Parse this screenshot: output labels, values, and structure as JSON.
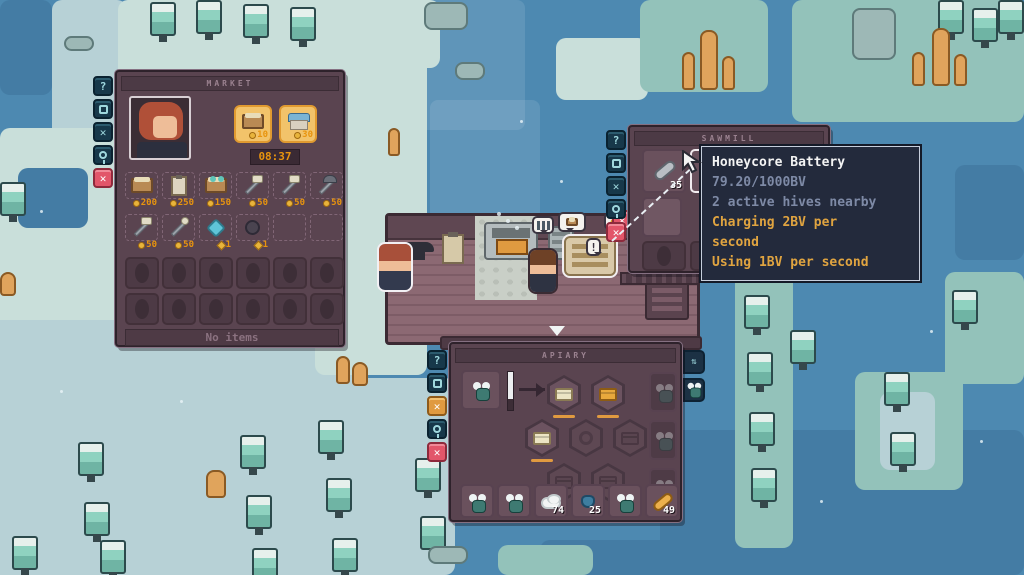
{
  "market": {
    "title": "MARKET",
    "offers": [
      {
        "name": "crate",
        "price": "10"
      },
      {
        "name": "market-stall",
        "price": "30"
      }
    ],
    "timer": "08:37",
    "shop_items": [
      {
        "name": "feed-crate",
        "price": "200"
      },
      {
        "name": "clipboard",
        "price": "250"
      },
      {
        "name": "frog-cart",
        "price": "150"
      },
      {
        "name": "shovel",
        "price": "50"
      },
      {
        "name": "axe",
        "price": "50"
      },
      {
        "name": "pickaxe",
        "price": "50"
      },
      {
        "name": "hammer",
        "price": "50"
      },
      {
        "name": "ladle",
        "price": "50"
      },
      {
        "name": "crystal",
        "price": "1"
      },
      {
        "name": "yarn",
        "price": "1"
      }
    ],
    "footer": "No items",
    "help_label": "?"
  },
  "sawmill": {
    "title": "SAWMILL",
    "battery_count": "35",
    "help_label": "?"
  },
  "battery_tooltip": {
    "title": "Honeycore Battery",
    "charge": "79.20/1000BV",
    "hives": "2 active hives nearby",
    "charging": "Charging 2BV per second",
    "using": "Using 1BV per second"
  },
  "apiary": {
    "title": "APIARY",
    "fluff_count": "74",
    "nectar_count": "25",
    "honey_count": "49",
    "help_label": "?"
  },
  "world": {
    "npc_bubble": "!",
    "coin_bubble": "¢",
    "close_label": "✕"
  },
  "colors": {
    "accent_orange": "#e8940e",
    "close_red": "#e2566a",
    "tooltip_bg": "#232a3c",
    "water": "#4d89b1"
  }
}
